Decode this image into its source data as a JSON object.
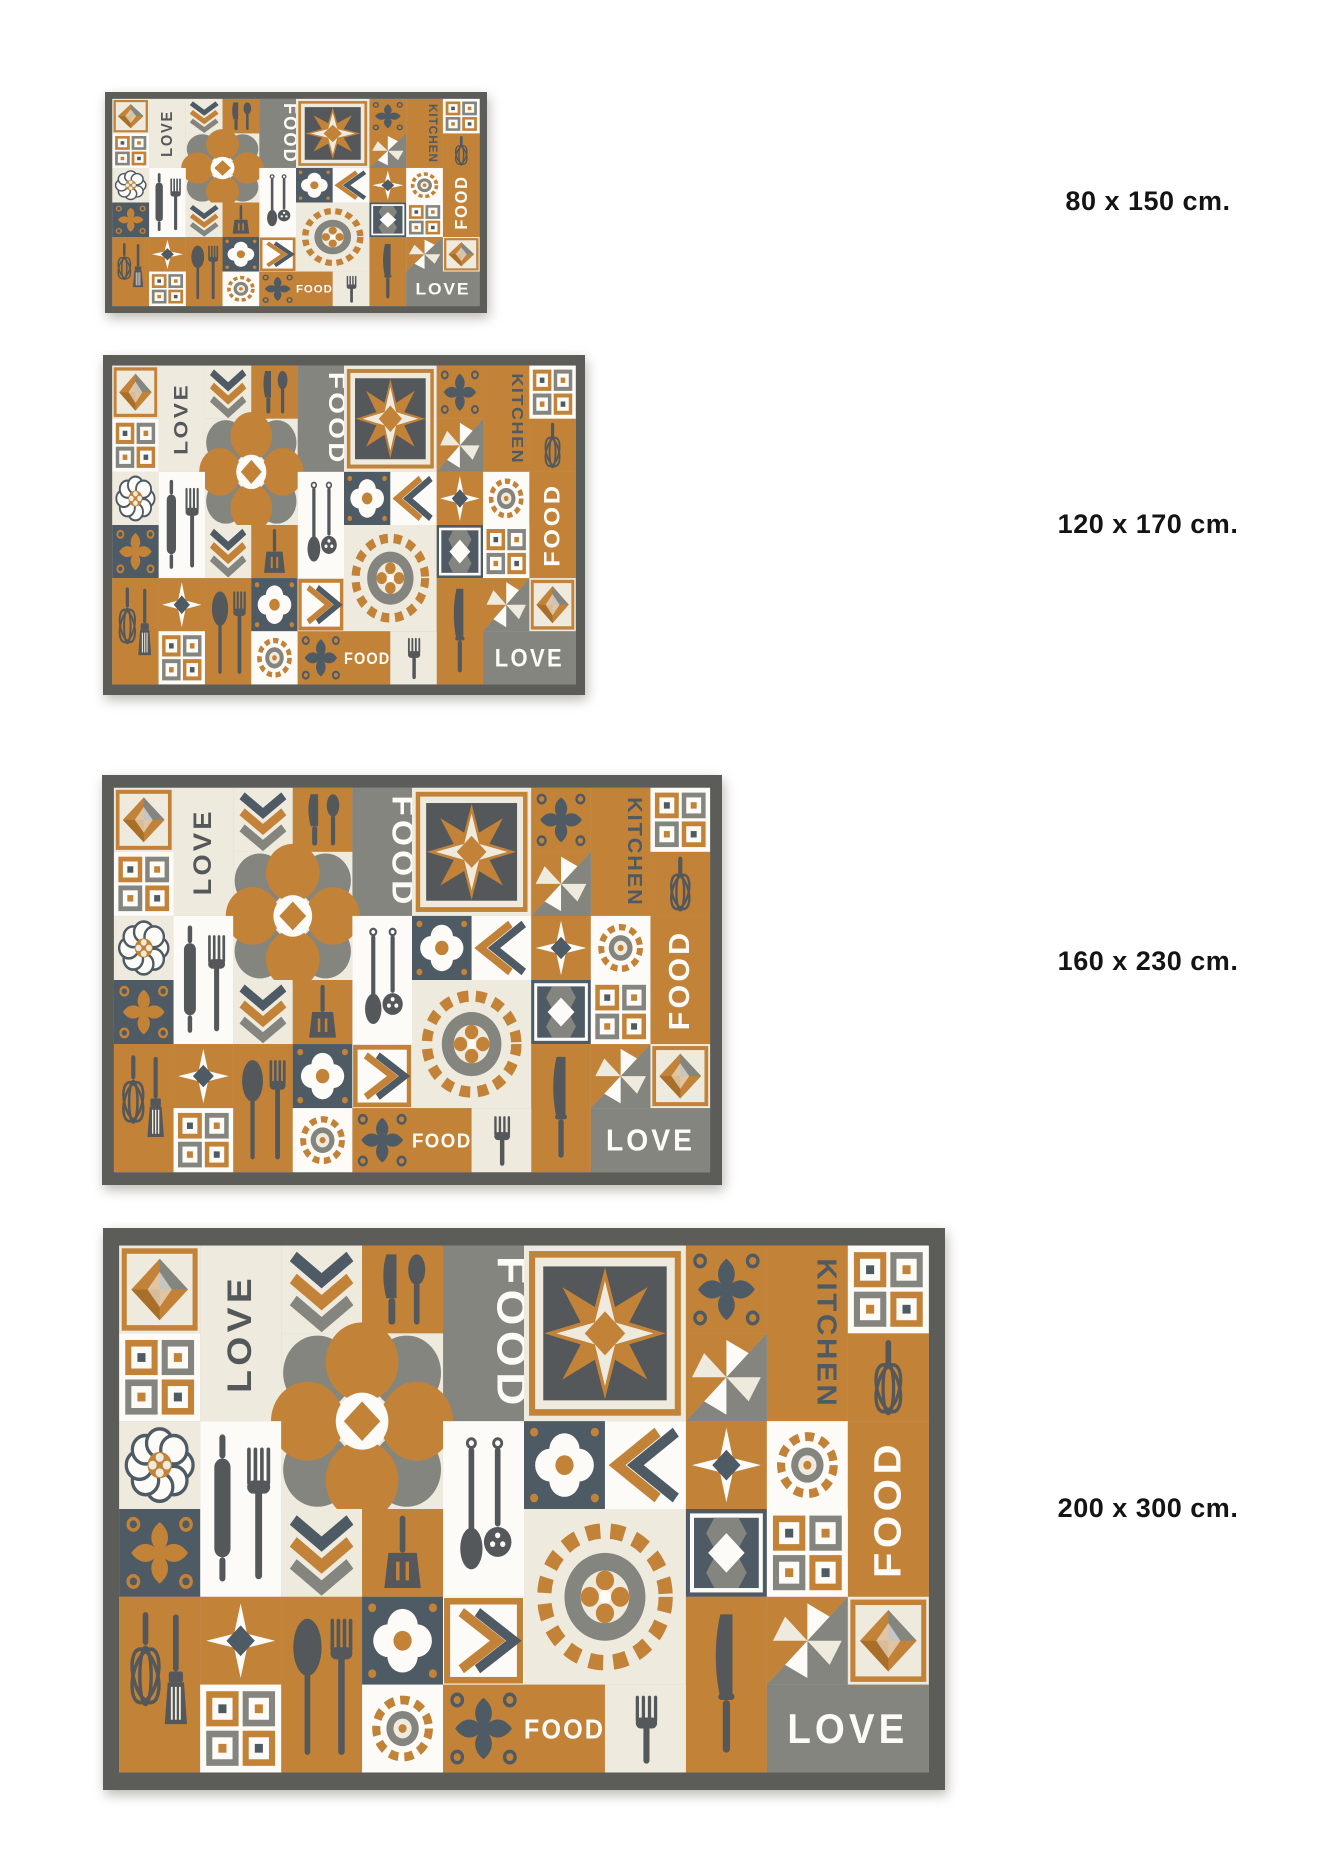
{
  "page": {
    "background_color": "#ffffff"
  },
  "size_chart": {
    "variants": [
      {
        "id": "80x150",
        "label": "80 x 150 cm."
      },
      {
        "id": "120x170",
        "label": "120 x 170 cm."
      },
      {
        "id": "160x230",
        "label": "160 x 230 cm."
      },
      {
        "id": "200x300",
        "label": "200 x 300 cm."
      }
    ]
  },
  "rug_design": {
    "words": {
      "love": "LOVE",
      "food": "FOOD",
      "kitchen": "KITCHEN"
    },
    "motifs": [
      "eight-point-star-medallion",
      "flower-medallion",
      "rosette-medallion",
      "quatrefoil-tile",
      "pinwheel-tile",
      "nested-squares-tile",
      "chevron-tile",
      "damask-ornament-tile",
      "faceted-gem-tile",
      "lace-flower-tile",
      "diamond-tile",
      "whisk",
      "pastry-brush",
      "rolling-pin",
      "fork",
      "knife",
      "spoon",
      "slotted-spoon",
      "spatula"
    ],
    "colors": {
      "ochre": "#c28238",
      "ochre-deep": "#a96f28",
      "slate": "#4e5a64",
      "charcoal": "#55585a",
      "gray": "#84857f",
      "cream": "#efeade",
      "white": "#fcfbf7",
      "border": "#5c5c58",
      "label-text": "#141414",
      "page-bg": "#ffffff"
    }
  }
}
